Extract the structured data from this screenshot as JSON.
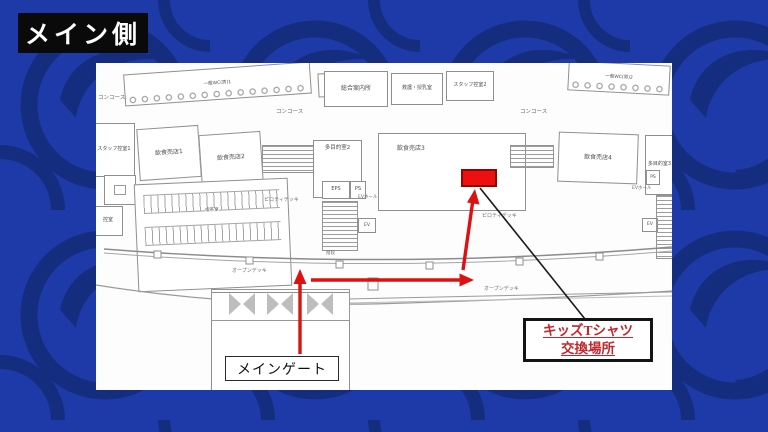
{
  "title": "メイン側",
  "colors": {
    "background": "#1e3aa8",
    "pattern": "#142d7e",
    "highlight_red": "#ee0f0f",
    "arrow_red": "#dd1111",
    "kids_text_red": "#c1272d"
  },
  "plan": {
    "concourse": "コンコース",
    "rooms": {
      "toilet_left": "一般WC(男)1",
      "info_desk": "総合案内所",
      "first_aid": "救護・授乳室",
      "staff_room_2": "スタッフ控室2",
      "toilet_right": "一般WC(男)2",
      "staff_room_1": "スタッフ控室1",
      "food_shop_1": "飲食売店1",
      "food_shop_2": "飲食売店2",
      "multi_room_2": "多目的室2",
      "food_shop_3": "飲食売店3",
      "food_shop_4": "飲食売店4",
      "multi_room_3": "多目的室3",
      "eps": "EPS",
      "ps": "PS",
      "ev_hall": "EVホール",
      "ev": "EV",
      "stairs": "階段",
      "tea_room": "喫茶室",
      "waiting_room": "控室"
    },
    "decks": {
      "piloti": "ピロティデッキ",
      "open": "オープンデッキ"
    }
  },
  "annotations": {
    "main_gate_label": "メインゲート",
    "kids_label_line1": "キッズTシャツ",
    "kids_label_line2": "交換場所"
  }
}
